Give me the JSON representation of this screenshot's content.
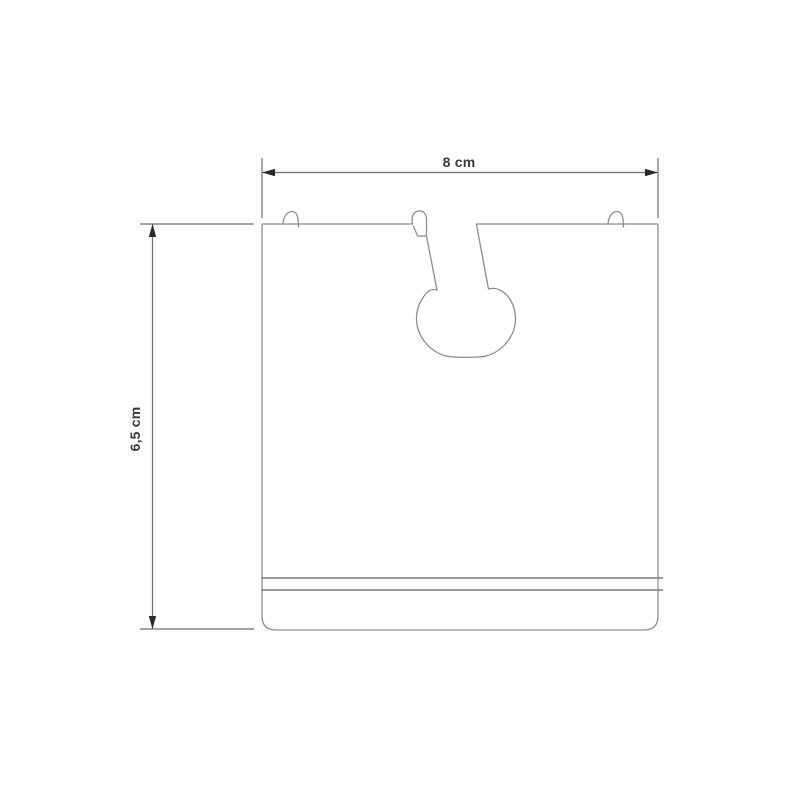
{
  "drawing": {
    "kind": "product-dimension-diagram",
    "dimensions": {
      "width_label": "8 cm",
      "height_label": "6,5 cm"
    },
    "colors": {
      "background": "#ffffff",
      "outline": "#8e8e8e",
      "detail_line": "#7b7b7b",
      "dimension_line": "#6e6e6e",
      "arrow": "#2b2b2b",
      "text": "#3a3a3a"
    }
  }
}
